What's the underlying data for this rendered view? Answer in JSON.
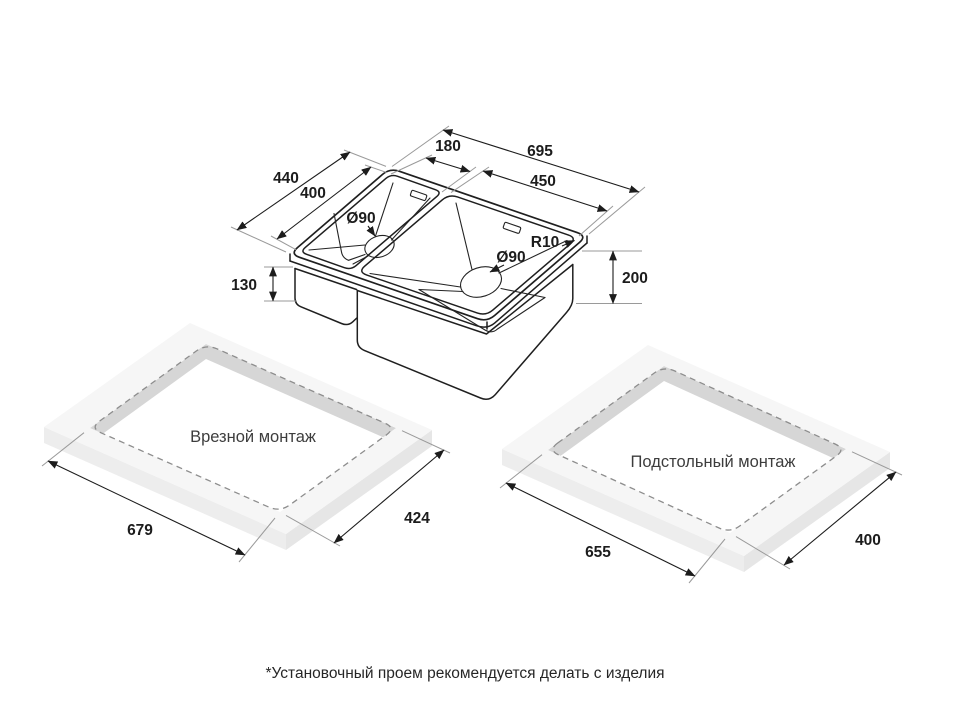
{
  "sink": {
    "dims": {
      "overall_length": "695",
      "small_bowl_width": "180",
      "large_bowl_width": "450",
      "overall_depth": "440",
      "bowl_depth": "400",
      "small_bowl_height": "130",
      "large_bowl_height": "200",
      "small_drain": "Ø90",
      "large_drain": "Ø90",
      "corner_radius": "R10"
    }
  },
  "mount_inset": {
    "label": "Врезной монтаж",
    "cutout_length": "679",
    "cutout_width": "424"
  },
  "mount_under": {
    "label": "Подстольный монтаж",
    "cutout_length": "655",
    "cutout_width": "400"
  },
  "footnote": "*Установочный проем рекомендуется делать с изделия",
  "colors": {
    "line": "#1f1f1f",
    "extension": "#9a9a9a",
    "dashed_cutout": "#8d8d8d",
    "panel_top": "#f6f6f6",
    "panel_front_left": "#ededed",
    "panel_front_right": "#e6e6e6",
    "cutout_wall": "#d6d6d6"
  }
}
